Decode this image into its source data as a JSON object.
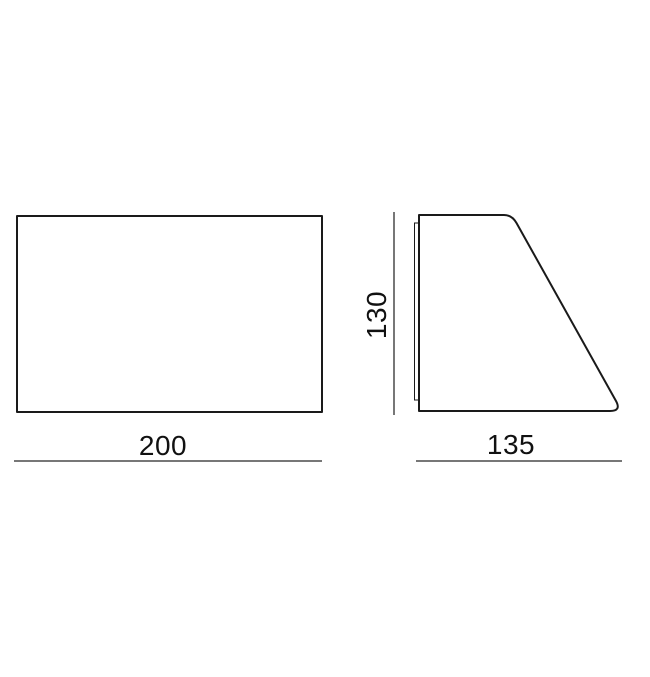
{
  "drawing": {
    "type": "technical-dimension-diagram",
    "background": "#ffffff",
    "colors": {
      "outline": "#1a1a1a",
      "dimension_line": "#4a4a4a",
      "text": "#111111"
    },
    "views": {
      "front": {
        "shape": "rectangle",
        "width_label": "200"
      },
      "side": {
        "shape": "right-trapezoid-rounded",
        "height_label": "130",
        "depth_label": "135"
      }
    },
    "dimensions": {
      "front_width": "200",
      "side_height": "130",
      "side_depth": "135"
    }
  }
}
